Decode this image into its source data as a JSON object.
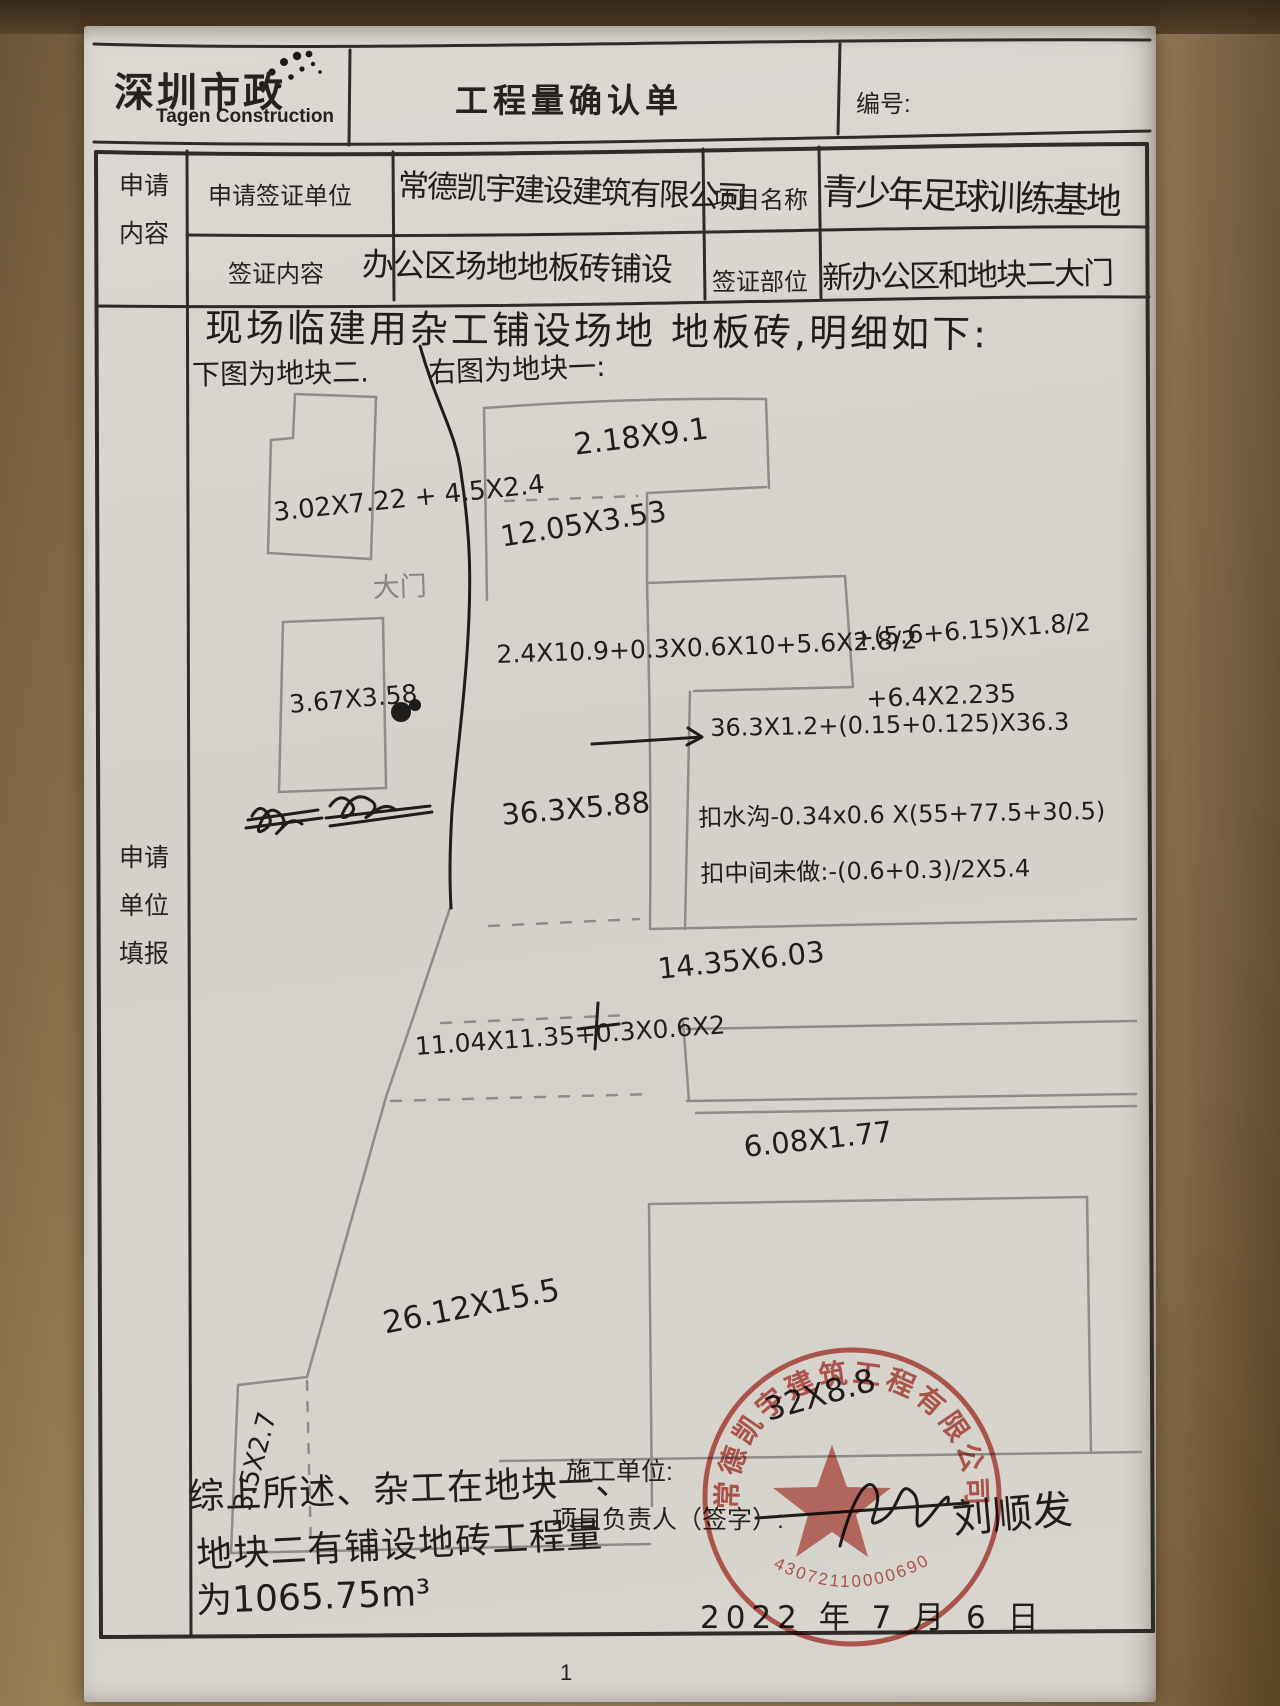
{
  "header": {
    "logo_cn": "深圳市政",
    "logo_en": "Tagen Construction",
    "title": "工程量确认单",
    "no_label": "编号:"
  },
  "form": {
    "left_top_lines": [
      "申请",
      "内容"
    ],
    "left_main_lines": [
      "申请",
      "单位",
      "填报"
    ],
    "rows": [
      {
        "label": "申请签证单位",
        "value": "常德凯宇建设建筑有限公司",
        "label2": "项目名称",
        "value2": "青少年足球训练基地"
      },
      {
        "label": "签证内容",
        "value": "办公区场地地板砖铺设",
        "label2": "签证部位",
        "value2": "新办公区和地块二大门"
      }
    ]
  },
  "notes": {
    "line1": "现场临建用杂工铺设场地 地板砖,明细如下:",
    "left_fig": "下图为地块二.",
    "right_fig": "右图为地块一:"
  },
  "diagram": {
    "labels": [
      {
        "text": "3.02X7.22 + 4.5X2.4",
        "x": 272,
        "y": 498,
        "rot": -6,
        "size": 26
      },
      {
        "text": "大门",
        "x": 372,
        "y": 566,
        "rot": -2,
        "size": 27,
        "ink": "pencil"
      },
      {
        "text": "3.67X3.58",
        "x": 288,
        "y": 690,
        "rot": -5,
        "size": 25
      },
      {
        "text": "2.18X9.1",
        "x": 572,
        "y": 428,
        "rot": -7,
        "size": 30
      },
      {
        "text": "12.05X3.53",
        "x": 498,
        "y": 520,
        "rot": -9,
        "size": 29
      },
      {
        "text": "2.4X10.9+0.3X0.6X10+5.6X2.8/2",
        "x": 496,
        "y": 640,
        "rot": -2,
        "size": 25
      },
      {
        "text": "+(5.6+6.15)X1.8/2",
        "x": 852,
        "y": 624,
        "rot": -4,
        "size": 25
      },
      {
        "text": "+6.4X2.235",
        "x": 866,
        "y": 684,
        "rot": -2,
        "size": 25
      },
      {
        "text": "36.3X5.88",
        "x": 500,
        "y": 798,
        "rot": -5,
        "size": 29
      },
      {
        "text": "36.3X1.2+(0.15+0.125)X36.3",
        "x": 710,
        "y": 714,
        "rot": -1,
        "size": 24
      },
      {
        "text": "扣水沟-0.34x0.6 X(55+77.5+30.5)",
        "x": 698,
        "y": 798,
        "rot": -1,
        "size": 24
      },
      {
        "text": "扣中间未做:-(0.6+0.3)/2X5.4",
        "x": 700,
        "y": 854,
        "rot": -1,
        "size": 24
      },
      {
        "text": "14.35X6.03",
        "x": 656,
        "y": 952,
        "rot": -6,
        "size": 29
      },
      {
        "text": "11.04X11.35+0.3X0.6X2",
        "x": 414,
        "y": 1032,
        "rot": -4,
        "size": 25
      },
      {
        "text": "6.08X1.77",
        "x": 742,
        "y": 1130,
        "rot": -6,
        "size": 29
      },
      {
        "text": "26.12X15.5",
        "x": 380,
        "y": 1306,
        "rot": -11,
        "size": 31
      },
      {
        "text": "3.5X2.7",
        "x": 228,
        "y": 1506,
        "rot": -75,
        "size": 26
      },
      {
        "text": "32X8.8",
        "x": 760,
        "y": 1392,
        "rot": -16,
        "size": 32
      }
    ]
  },
  "summary": {
    "line1": "综上所述、杂工在地块一、",
    "line2": "地块二有铺设地砖工程量",
    "line3": "为1065.75m³"
  },
  "footer": {
    "contractor_label": "施工单位:",
    "manager_label": "项目负责人（签字）:",
    "signature": "刘顺发",
    "date": "2022 年 7 月 6 日",
    "page_number": "1"
  },
  "stamp": {
    "company": "常德凯宇建筑工程有限公司",
    "number": "43072110000690"
  }
}
